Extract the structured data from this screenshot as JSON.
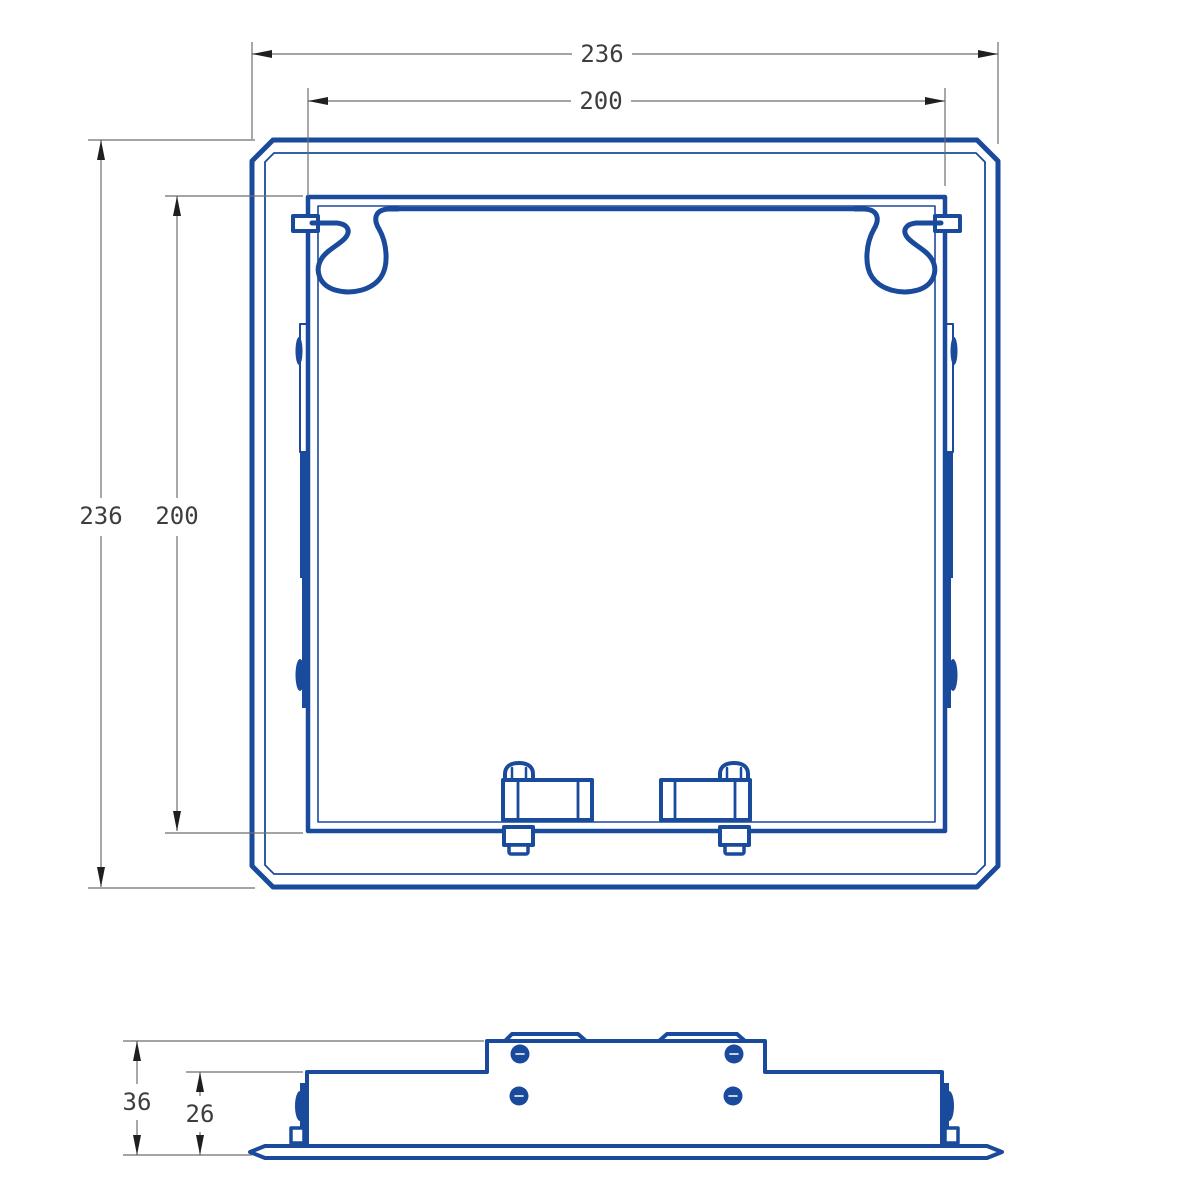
{
  "drawing": {
    "type": "technical-drawing-access-panel",
    "background_color": "#ffffff",
    "part_line_color": "#1a4a9b",
    "dimension_line_color": "#6e6e6e",
    "dimension_text_color": "#3e3e3e",
    "views": {
      "front_view": {
        "description": "front elevation of square access panel with outer frame, inner door, top spring clips and bottom cam latches"
      },
      "side_view": {
        "description": "side profile of panel showing depth, latch bolts and mounting clips"
      }
    },
    "dimensions": {
      "front_outer_width": "236",
      "front_inner_width": "200",
      "front_outer_height": "236",
      "front_inner_height": "200",
      "side_overall_depth": "36",
      "side_panel_depth": "26"
    }
  }
}
